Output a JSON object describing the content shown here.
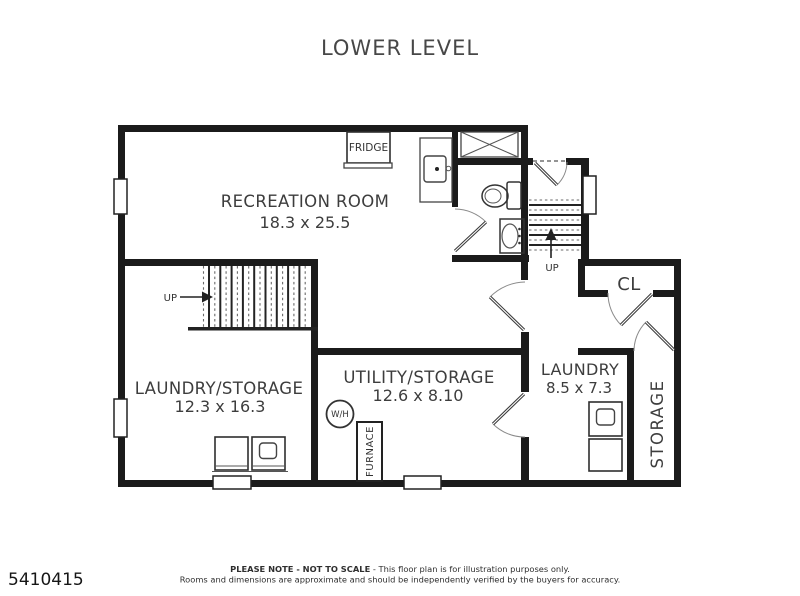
{
  "title": "LOWER LEVEL",
  "listing_id": "5410415",
  "rooms": {
    "recreation": {
      "name": "RECREATION ROOM",
      "dims": "18.3 x 25.5"
    },
    "laundry_storage": {
      "name": "LAUNDRY/STORAGE",
      "dims": "12.3 x 16.3"
    },
    "utility_storage": {
      "name": "UTILITY/STORAGE",
      "dims": "12.6 x 8.10"
    },
    "laundry": {
      "name": "LAUNDRY",
      "dims": "8.5 x 7.3"
    },
    "storage": {
      "name": "STORAGE"
    },
    "closet": {
      "name": "CL"
    }
  },
  "labels": {
    "fridge": "FRIDGE",
    "furnace": "FURNACE",
    "water_heater": "W/H",
    "stairs_up_left": "UP",
    "stairs_up_right": "UP"
  },
  "footer": {
    "note_bold": "PLEASE NOTE - NOT TO SCALE",
    "note_regular": " - This floor plan is for illustration purposes only.",
    "disclaimer": "Rooms and dimensions are approximate and should be independently verified by the buyers for accuracy."
  },
  "colors": {
    "wall": "#1b1b1b",
    "label": "#3d3d3d",
    "background": "#ffffff"
  }
}
